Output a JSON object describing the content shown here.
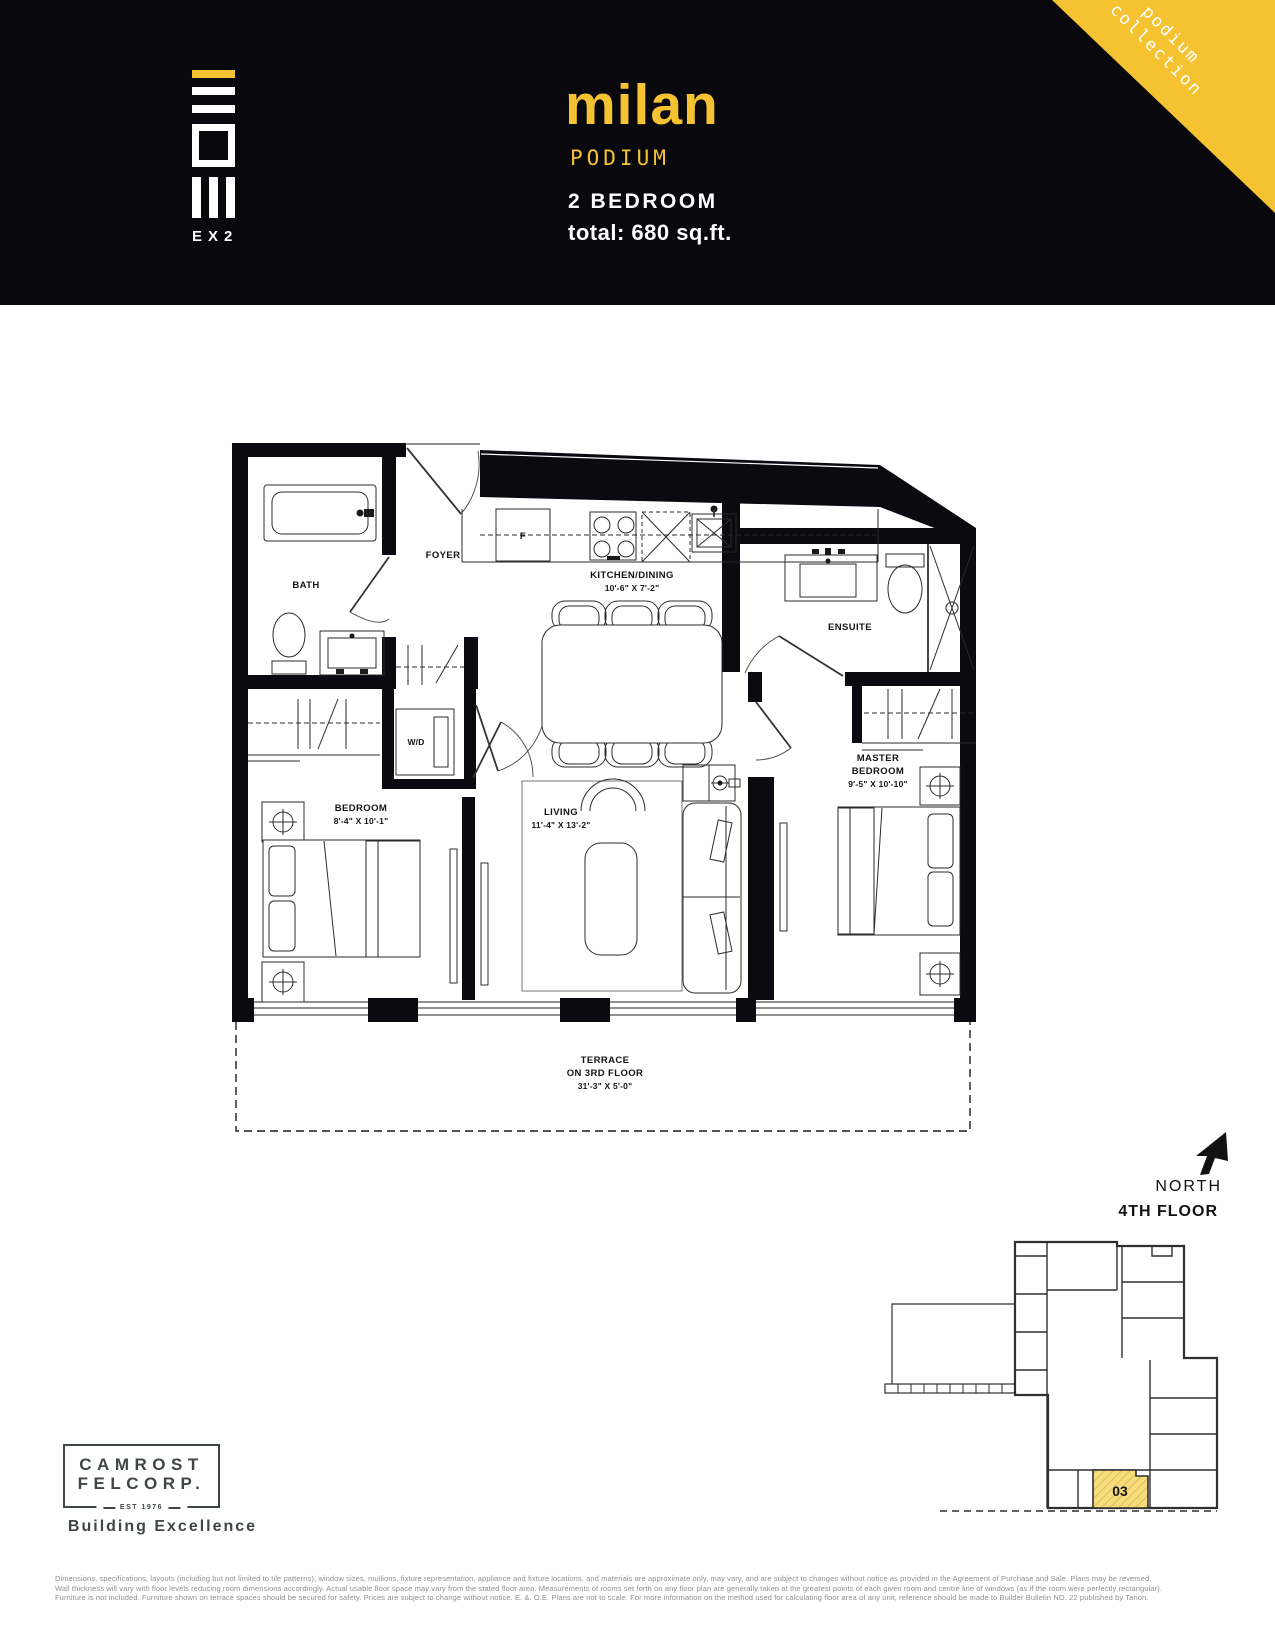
{
  "header": {
    "brand": "EX2",
    "unit_name": "milan",
    "collection": "PODIUM",
    "bedroom_count": "2 BEDROOM",
    "total_area": "total: 680 sq.ft.",
    "badge_line1": "podium",
    "badge_line2": "collection"
  },
  "floor_plan": {
    "bath": "BATH",
    "foyer": "FOYER",
    "kitchen_dining": "KITCHEN/DINING",
    "kitchen_dining_dims": "10'-6\" X 7'-2\"",
    "ensuite": "ENSUITE",
    "bedroom": "BEDROOM",
    "bedroom_dims": "8'-4\" X 10'-1\"",
    "washer_dryer": "W/D",
    "fridge": "F",
    "living": "LIVING",
    "living_dims": "11'-4\" X 13'-2\"",
    "master_line1": "MASTER",
    "master_line2": "BEDROOM",
    "master_dims": "9'-5\" X 10'-10\"",
    "terrace_line1": "TERRACE",
    "terrace_line2": "ON 3RD FLOOR",
    "terrace_dims": "31'-3\" X 5'-0\""
  },
  "compass": {
    "north_label": "NORTH"
  },
  "key_plan": {
    "floor_label": "4TH FLOOR",
    "unit_number": "03"
  },
  "footer": {
    "builder_name_line1": "CAMROST",
    "builder_name_line2": "FELCORP.",
    "builder_est": "EST 1976",
    "builder_tagline": "Building Excellence",
    "disclaimer_line1": "Dimensions, specifications, layouts (including but not limited to tile patterns), window sizes, mullions, fixture representation, appliance and fixture locations, and materials are approximate only, may vary, and are subject to changes without notice as provided in the Agreement of Purchase and Sale.  Plans may be reversed.",
    "disclaimer_line2": "Wall thickness will vary with floor levels reducing room dimensions accordingly. Actual usable floor space may vary from the stated floor area.  Measurements of rooms set forth on any floor plan are generally taken at the greatest points of each given room and centre line of windows (as if the room were perfectly rectangular).",
    "disclaimer_line3": "Furniture is not included.  Furniture shown on terrace spaces should be secured for safety.  Prices are subject to change without notice. E. &. O.E. Plans are not to scale. For more information on the method used for calculating floor area of any unit, reference should be made to Builder Bulletin NO. 22 published by Tarion."
  },
  "colors": {
    "accent_yellow": "#F5C332",
    "header_black": "#08080D",
    "logo_gray": "#3E4745",
    "highlight_unit_fill": "#F6DC7D"
  }
}
